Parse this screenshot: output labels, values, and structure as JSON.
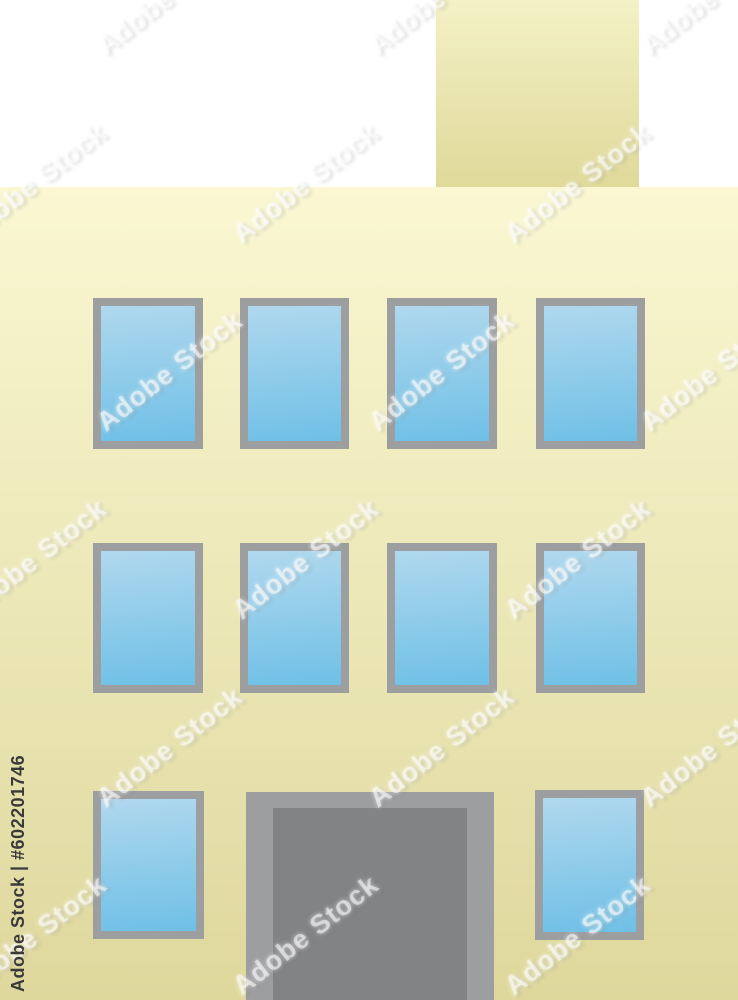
{
  "image": {
    "width": 738,
    "height": 1000,
    "background_color": "#ffffff"
  },
  "watermark": {
    "tile_text": "Adobe Stock",
    "tile_color": "rgba(255,255,255,0.52)",
    "stock_id_text": "Adobe Stock | #602201746",
    "stock_id_color": "#3a3a3a",
    "stock_id_left": 8,
    "stock_id_baseline_y": 992,
    "tile_rows_start_y": -20,
    "tile_row_step": 188,
    "tile_col_step": 272,
    "tile_odd_row_offset": 136,
    "tile_cols_start_x": -190
  },
  "building": {
    "chimney": {
      "x": 436,
      "y": 0,
      "w": 203,
      "h": 187,
      "color_top": "#f4f1c6",
      "color_bottom": "#dfd99a"
    },
    "wall": {
      "x": 0,
      "y": 187,
      "w": 738,
      "h": 813,
      "color_top": "#faf7d2",
      "color_bottom": "#ded89d"
    },
    "window_style": {
      "frame_color": "#9d9ea0",
      "glass_color_top": "#b0d8ee",
      "glass_color_bottom": "#6fc0e6"
    },
    "windows": [
      {
        "x": 93,
        "y": 298,
        "w": 110,
        "h": 151
      },
      {
        "x": 240,
        "y": 298,
        "w": 109,
        "h": 151
      },
      {
        "x": 387,
        "y": 298,
        "w": 110,
        "h": 151
      },
      {
        "x": 536,
        "y": 298,
        "w": 109,
        "h": 151
      },
      {
        "x": 93,
        "y": 543,
        "w": 110,
        "h": 150
      },
      {
        "x": 240,
        "y": 543,
        "w": 109,
        "h": 150
      },
      {
        "x": 387,
        "y": 543,
        "w": 110,
        "h": 150
      },
      {
        "x": 536,
        "y": 543,
        "w": 109,
        "h": 150
      },
      {
        "x": 93,
        "y": 791,
        "w": 111,
        "h": 148
      },
      {
        "x": 535,
        "y": 790,
        "w": 109,
        "h": 150
      }
    ],
    "door": {
      "outer": {
        "x": 246,
        "y": 792,
        "w": 248,
        "h": 208,
        "color": "#9d9ea0"
      },
      "inner": {
        "color": "#828385"
      }
    }
  }
}
